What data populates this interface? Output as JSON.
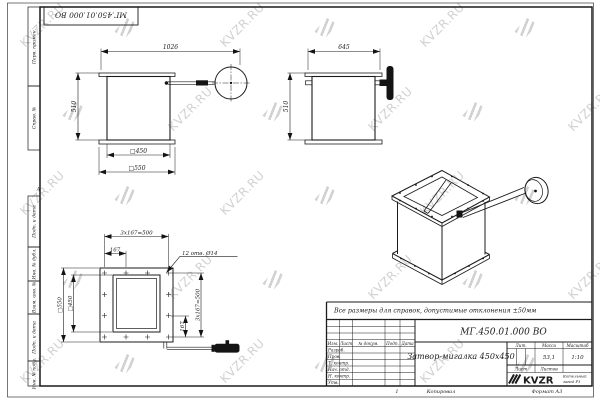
{
  "watermark": {
    "text": "KVZR.RU"
  },
  "top_stamp": {
    "designation": "МГ.450.01.000 ВО"
  },
  "side_strip": {
    "labels": [
      "Перв. примен.",
      "Справ. №",
      "Подп. и дата",
      "Инв. № дубл.",
      "Взам. инв. №",
      "Подп. и дата",
      "Инв. № подл."
    ],
    "zone_marker": "А"
  },
  "note": "Все размеры для справок, допустимые отклонения ±50мм",
  "views": {
    "front": {
      "dim_overall_width": "1026",
      "dim_height": "510",
      "dim_inner": "□450",
      "dim_outer": "□550"
    },
    "side": {
      "dim_overall_width": "645",
      "dim_height": "510"
    },
    "plan": {
      "dim_bolt_pitch_top": "3x167=500",
      "dim_offset_top": "167",
      "holes_note": "12 отв. Ø14",
      "dim_outer": "□550",
      "dim_inner": "□450",
      "dim_offset_right": "167",
      "dim_bolt_pitch_right": "3x167=500"
    }
  },
  "title_block": {
    "designation": "МГ.450.01.000 ВО",
    "name": "Затвор-мигалка 450х450",
    "header_cols": [
      "Изм.",
      "Лист",
      "№ докум.",
      "Подп.",
      "Дата"
    ],
    "signature_rows": [
      "Разраб.",
      "Пров.",
      "Т. контр.",
      "Нач. отд.",
      "Н. контр.",
      "Утв."
    ],
    "lit_label": "Лит.",
    "mass_label": "Масса",
    "scale_label": "Масштаб",
    "mass_value": "53,1",
    "scale_value": "1:10",
    "sheet_label": "Лист",
    "sheets_label": "Листов",
    "logo_text": "KVZR",
    "company_line1": "Котельный",
    "company_line2": "завод РЗ",
    "zone_number": "1",
    "copied_label": "Копировал",
    "format_label": "Формат А3"
  }
}
